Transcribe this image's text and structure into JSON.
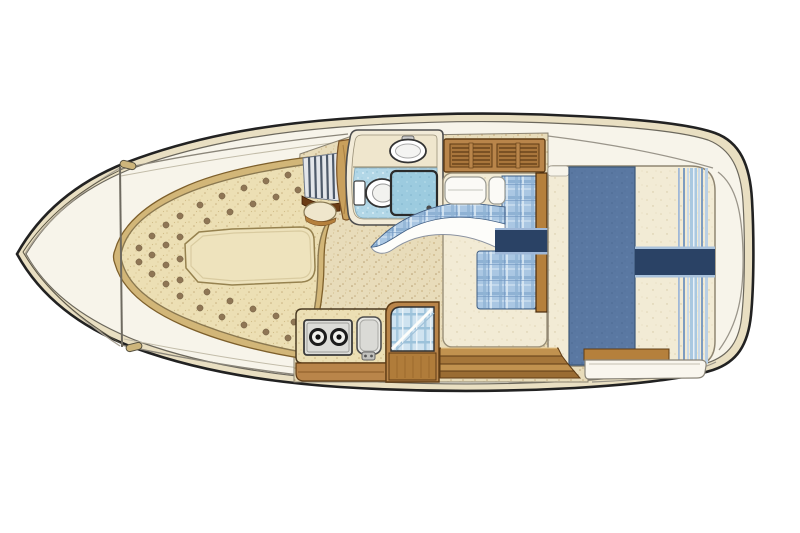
{
  "meta": {
    "type": "boat-interior-floor-plan",
    "view": "top-down-illustration",
    "text_on_image": ""
  },
  "palette": {
    "background": "#ffffff",
    "hull_outline": "#222222",
    "hull_band": "#e9dfc2",
    "deck": "#f7f4ea",
    "line_soft": "#9a958a",
    "floor_base": "#e8dcba",
    "cushion_base": "#ecdfb4",
    "cushion_rim_wood": "#d2b678",
    "cushion_dot": "#8f7655",
    "insert_cushion": "#eee3bd",
    "wood": "#b9854a",
    "wood_dark": "#5f3c15",
    "wood_rail": "#b5803c",
    "head_wall": "#f2ebd8",
    "head_shelf": "#efe6cd",
    "tile_blue": "#b2d7e7",
    "shower_blue": "#9ccbdf",
    "fixture_white": "#ffffff",
    "pillow_white": "#fbfaf6",
    "plaid_blue": "#a9c6e2",
    "navy": "#2a4265",
    "navy_edge_light": "#9fb8d8",
    "blanket_blue": "#5a78a2",
    "mattress_cream": "#f2ebd5",
    "stove_steel": "#dcdcd8",
    "burner_black": "#1c1c1c",
    "sink_gray": "#e8e8e4",
    "hatch_white": "#f9f6ee",
    "step_wood_light": "#c1924f",
    "step_wood_dark": "#a5763a"
  },
  "counts": {
    "stove_burners": 2,
    "step_planks": 4,
    "louver_panels": 2,
    "berth_pillows": 2
  },
  "elements": [
    "hull",
    "foredeck",
    "windshield-bulkhead",
    "v-berth",
    "insert-cushion",
    "head-compartment",
    "sink",
    "toilet",
    "shower-pan",
    "louvered-cabinet",
    "port-berth",
    "aft-double-bed",
    "galley-stove",
    "galley-sink",
    "companionway",
    "mid-cabin-berth",
    "cabin-steps",
    "engine-hatch"
  ],
  "v_berth": {
    "tuft_dots": [
      [
        139,
        248
      ],
      [
        139,
        262
      ],
      [
        152,
        236
      ],
      [
        152,
        255
      ],
      [
        152,
        274
      ],
      [
        166,
        225
      ],
      [
        166,
        245
      ],
      [
        166,
        265
      ],
      [
        166,
        284
      ],
      [
        180,
        216
      ],
      [
        180,
        237
      ],
      [
        180,
        259
      ],
      [
        180,
        280
      ],
      [
        180,
        296
      ],
      [
        200,
        205
      ],
      [
        222,
        196
      ],
      [
        244,
        188
      ],
      [
        266,
        181
      ],
      [
        288,
        175
      ],
      [
        310,
        169
      ],
      [
        331,
        165
      ],
      [
        207,
        221
      ],
      [
        230,
        212
      ],
      [
        253,
        204
      ],
      [
        276,
        197
      ],
      [
        298,
        190
      ],
      [
        200,
        308
      ],
      [
        222,
        317
      ],
      [
        244,
        325
      ],
      [
        266,
        332
      ],
      [
        288,
        338
      ],
      [
        300,
        344
      ],
      [
        207,
        292
      ],
      [
        230,
        301
      ],
      [
        253,
        309
      ],
      [
        276,
        316
      ],
      [
        294,
        322
      ]
    ]
  }
}
